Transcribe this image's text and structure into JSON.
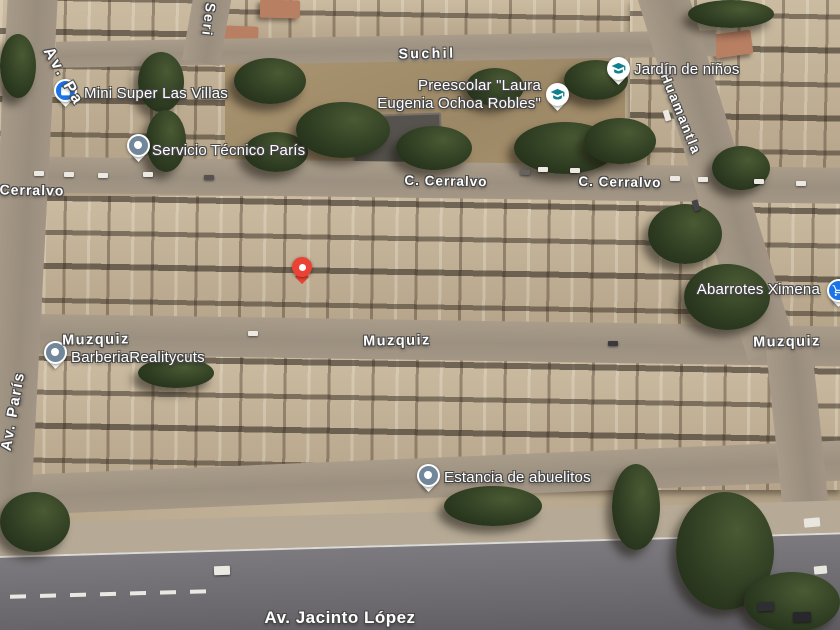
{
  "map": {
    "view": "satellite",
    "street_labels": [
      {
        "text": "Av. Pa"
      },
      {
        "text": "Seri"
      },
      {
        "text": "Suchil"
      },
      {
        "text": "C. Cerralvo"
      },
      {
        "text": "C. Cerralvo"
      },
      {
        "text": "Cerralvo"
      },
      {
        "text": "Huamantla"
      },
      {
        "text": "Muzquiz"
      },
      {
        "text": "Muzquiz"
      },
      {
        "text": "Muzquiz"
      },
      {
        "text": "Av. París"
      },
      {
        "text": "Av. Jacinto López"
      }
    ],
    "pois": [
      {
        "name": "Mini Super Las Villas",
        "icon": "shopping-bag",
        "color": "#1A73E8"
      },
      {
        "name": "Servicio Técnico París",
        "icon": "generic-dot",
        "color": "#72889A"
      },
      {
        "name": "Preescolar \"Laura Eugenia Ochoa Robles\"",
        "line1": "Preescolar \"Laura",
        "line2": "Eugenia Ochoa Robles\"",
        "icon": "school",
        "color": "#0E828C"
      },
      {
        "name": "Jardín de niños",
        "icon": "school",
        "color": "#0E828C"
      },
      {
        "name": "Abarrotes Ximena",
        "icon": "shopping-cart",
        "color": "#1A73E8"
      },
      {
        "name": "BarberiaRealitycuts",
        "icon": "generic-dot",
        "color": "#72889A"
      },
      {
        "name": "Estancia de abuelitos",
        "icon": "generic-dot",
        "color": "#72889A"
      }
    ],
    "marker": {
      "name": "dropped-pin",
      "color": "#EA4335"
    },
    "colors": {
      "label_halo": "#474747",
      "terrain": "#B9A78C",
      "road": "#9F9384",
      "avenue_asphalt": "#6B696E",
      "tree": "#2F3D22"
    }
  }
}
